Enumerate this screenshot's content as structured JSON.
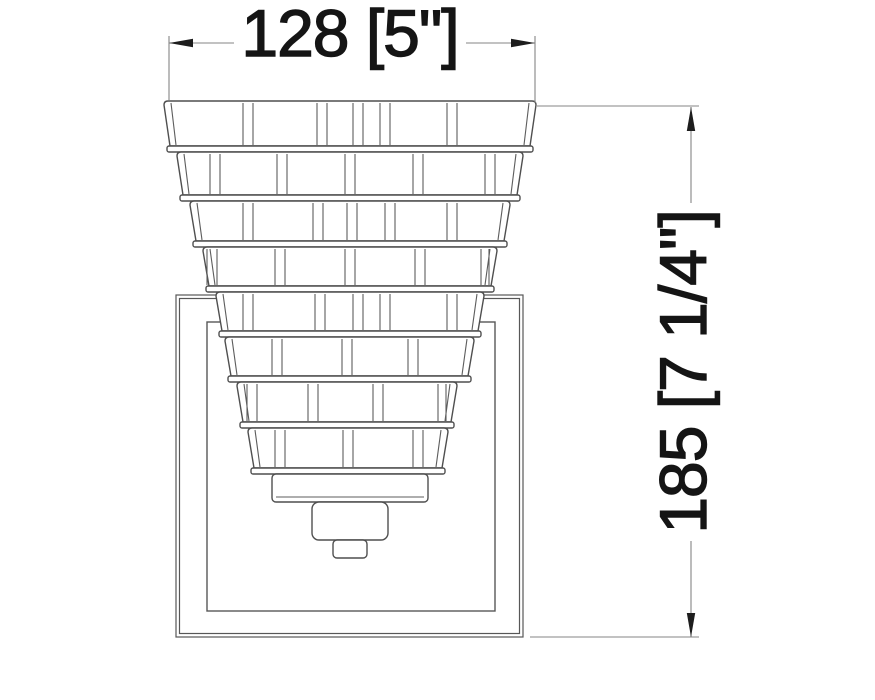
{
  "drawing": {
    "kind": "technical-elevation",
    "subject": "tiered-glass-wall-sconce-front-view",
    "width_dimension": {
      "label": "128 [5\"]",
      "millimeters": "128",
      "inches": "5\""
    },
    "height_dimension": {
      "label": "185 [7 1/4\"]",
      "millimeters": "185",
      "inches": "7 1/4\""
    },
    "colors": {
      "background": "#ffffff",
      "fixture_line": "#4f4f4f",
      "backplate_line": "#575757",
      "dimension_line": "#868686",
      "arrow": "#1d1d1d",
      "text": "#151515"
    }
  }
}
